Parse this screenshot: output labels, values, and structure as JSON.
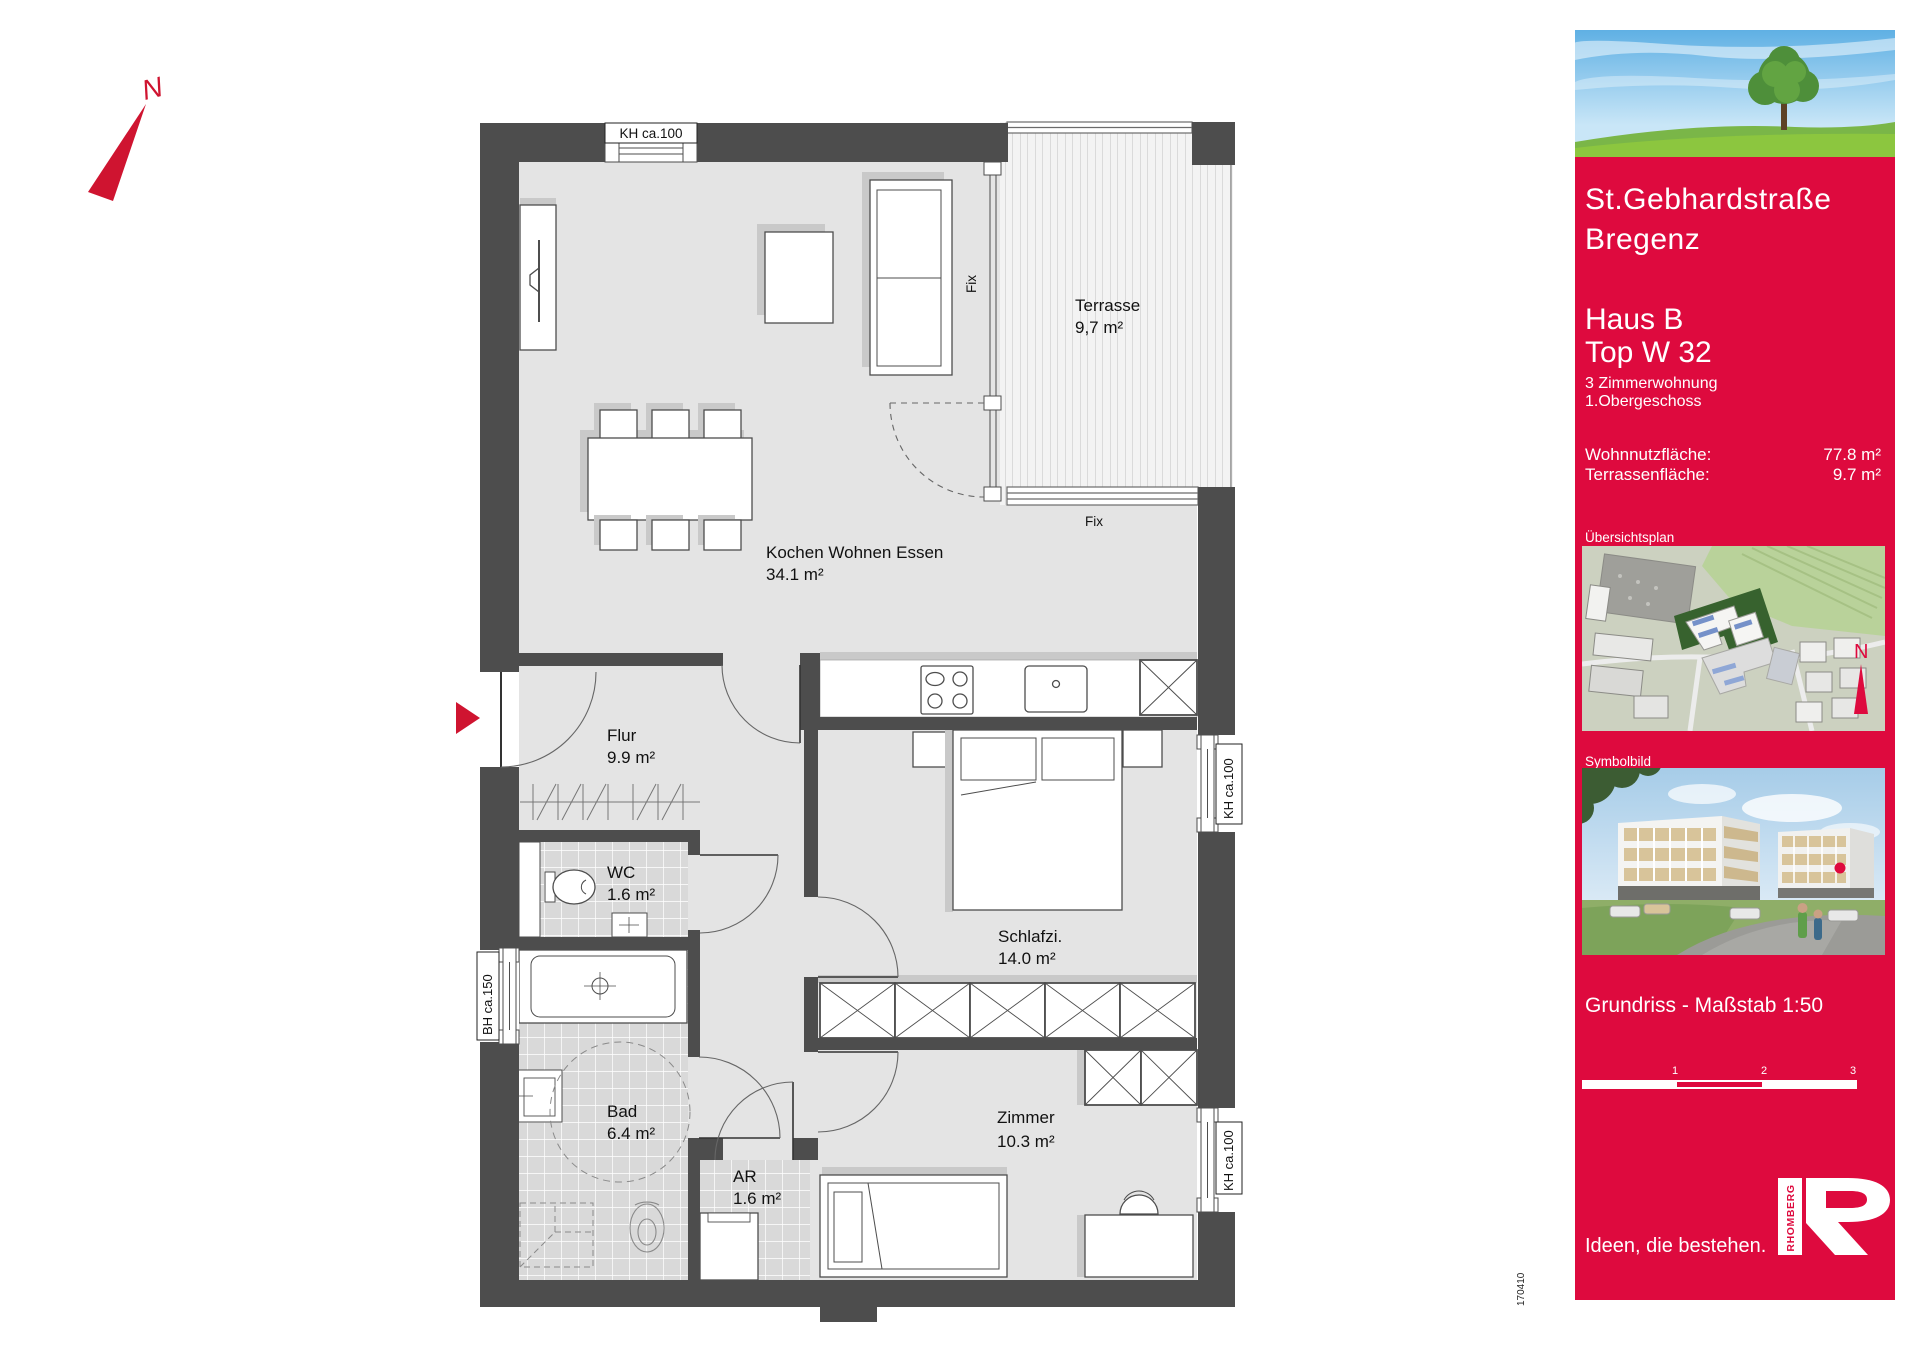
{
  "plan": {
    "compass_label": "N",
    "entry_marker": "entrance",
    "project_number": "170410",
    "rooms": [
      {
        "name": "Terrasse",
        "area": "9,7 m²"
      },
      {
        "name": "Kochen Wohnen Essen",
        "area": "34.1 m²"
      },
      {
        "name": "Flur",
        "area": "9.9 m²"
      },
      {
        "name": "WC",
        "area": "1.6 m²"
      },
      {
        "name": "Schlafzi.",
        "area": "14.0 m²"
      },
      {
        "name": "Bad",
        "area": "6.4 m²"
      },
      {
        "name": "AR",
        "area": "1.6 m²"
      },
      {
        "name": "Zimmer",
        "area": "10.3 m²"
      }
    ],
    "annotations": {
      "top_window": "KH ca.100",
      "left_window": "BH ca.150",
      "right_window_upper": "KH ca.100",
      "right_window_lower": "KH ca.100",
      "fix_vertical": "Fix",
      "fix_bottom": "Fix"
    }
  },
  "sidebar": {
    "title_line1": "St.Gebhardstraße",
    "title_line2": "Bregenz",
    "house": "Haus B",
    "unit": "Top W 32",
    "unit_type": "3 Zimmerwohnung",
    "floor": "1.Obergeschoss",
    "areas": [
      {
        "label": "Wohnnutzfläche:",
        "value": "77.8 m²"
      },
      {
        "label": "Terrassenfläche:",
        "value": "9.7 m²"
      }
    ],
    "overview_label": "Übersichtsplan",
    "symbol_label": "Symbolbild",
    "plan_scale": "Grundriss - Maßstab 1:50",
    "scale_ticks": [
      "1",
      "2",
      "3"
    ],
    "slogan": "Ideen, die bestehen.",
    "logo_text": "RHOMBERG",
    "overview_compass": "N",
    "colors": {
      "brand_red": "#de0a3e",
      "compass_red": "#cf1430",
      "wall_gray": "#4d4d4d",
      "floor_gray": "#e4e4e4"
    }
  }
}
